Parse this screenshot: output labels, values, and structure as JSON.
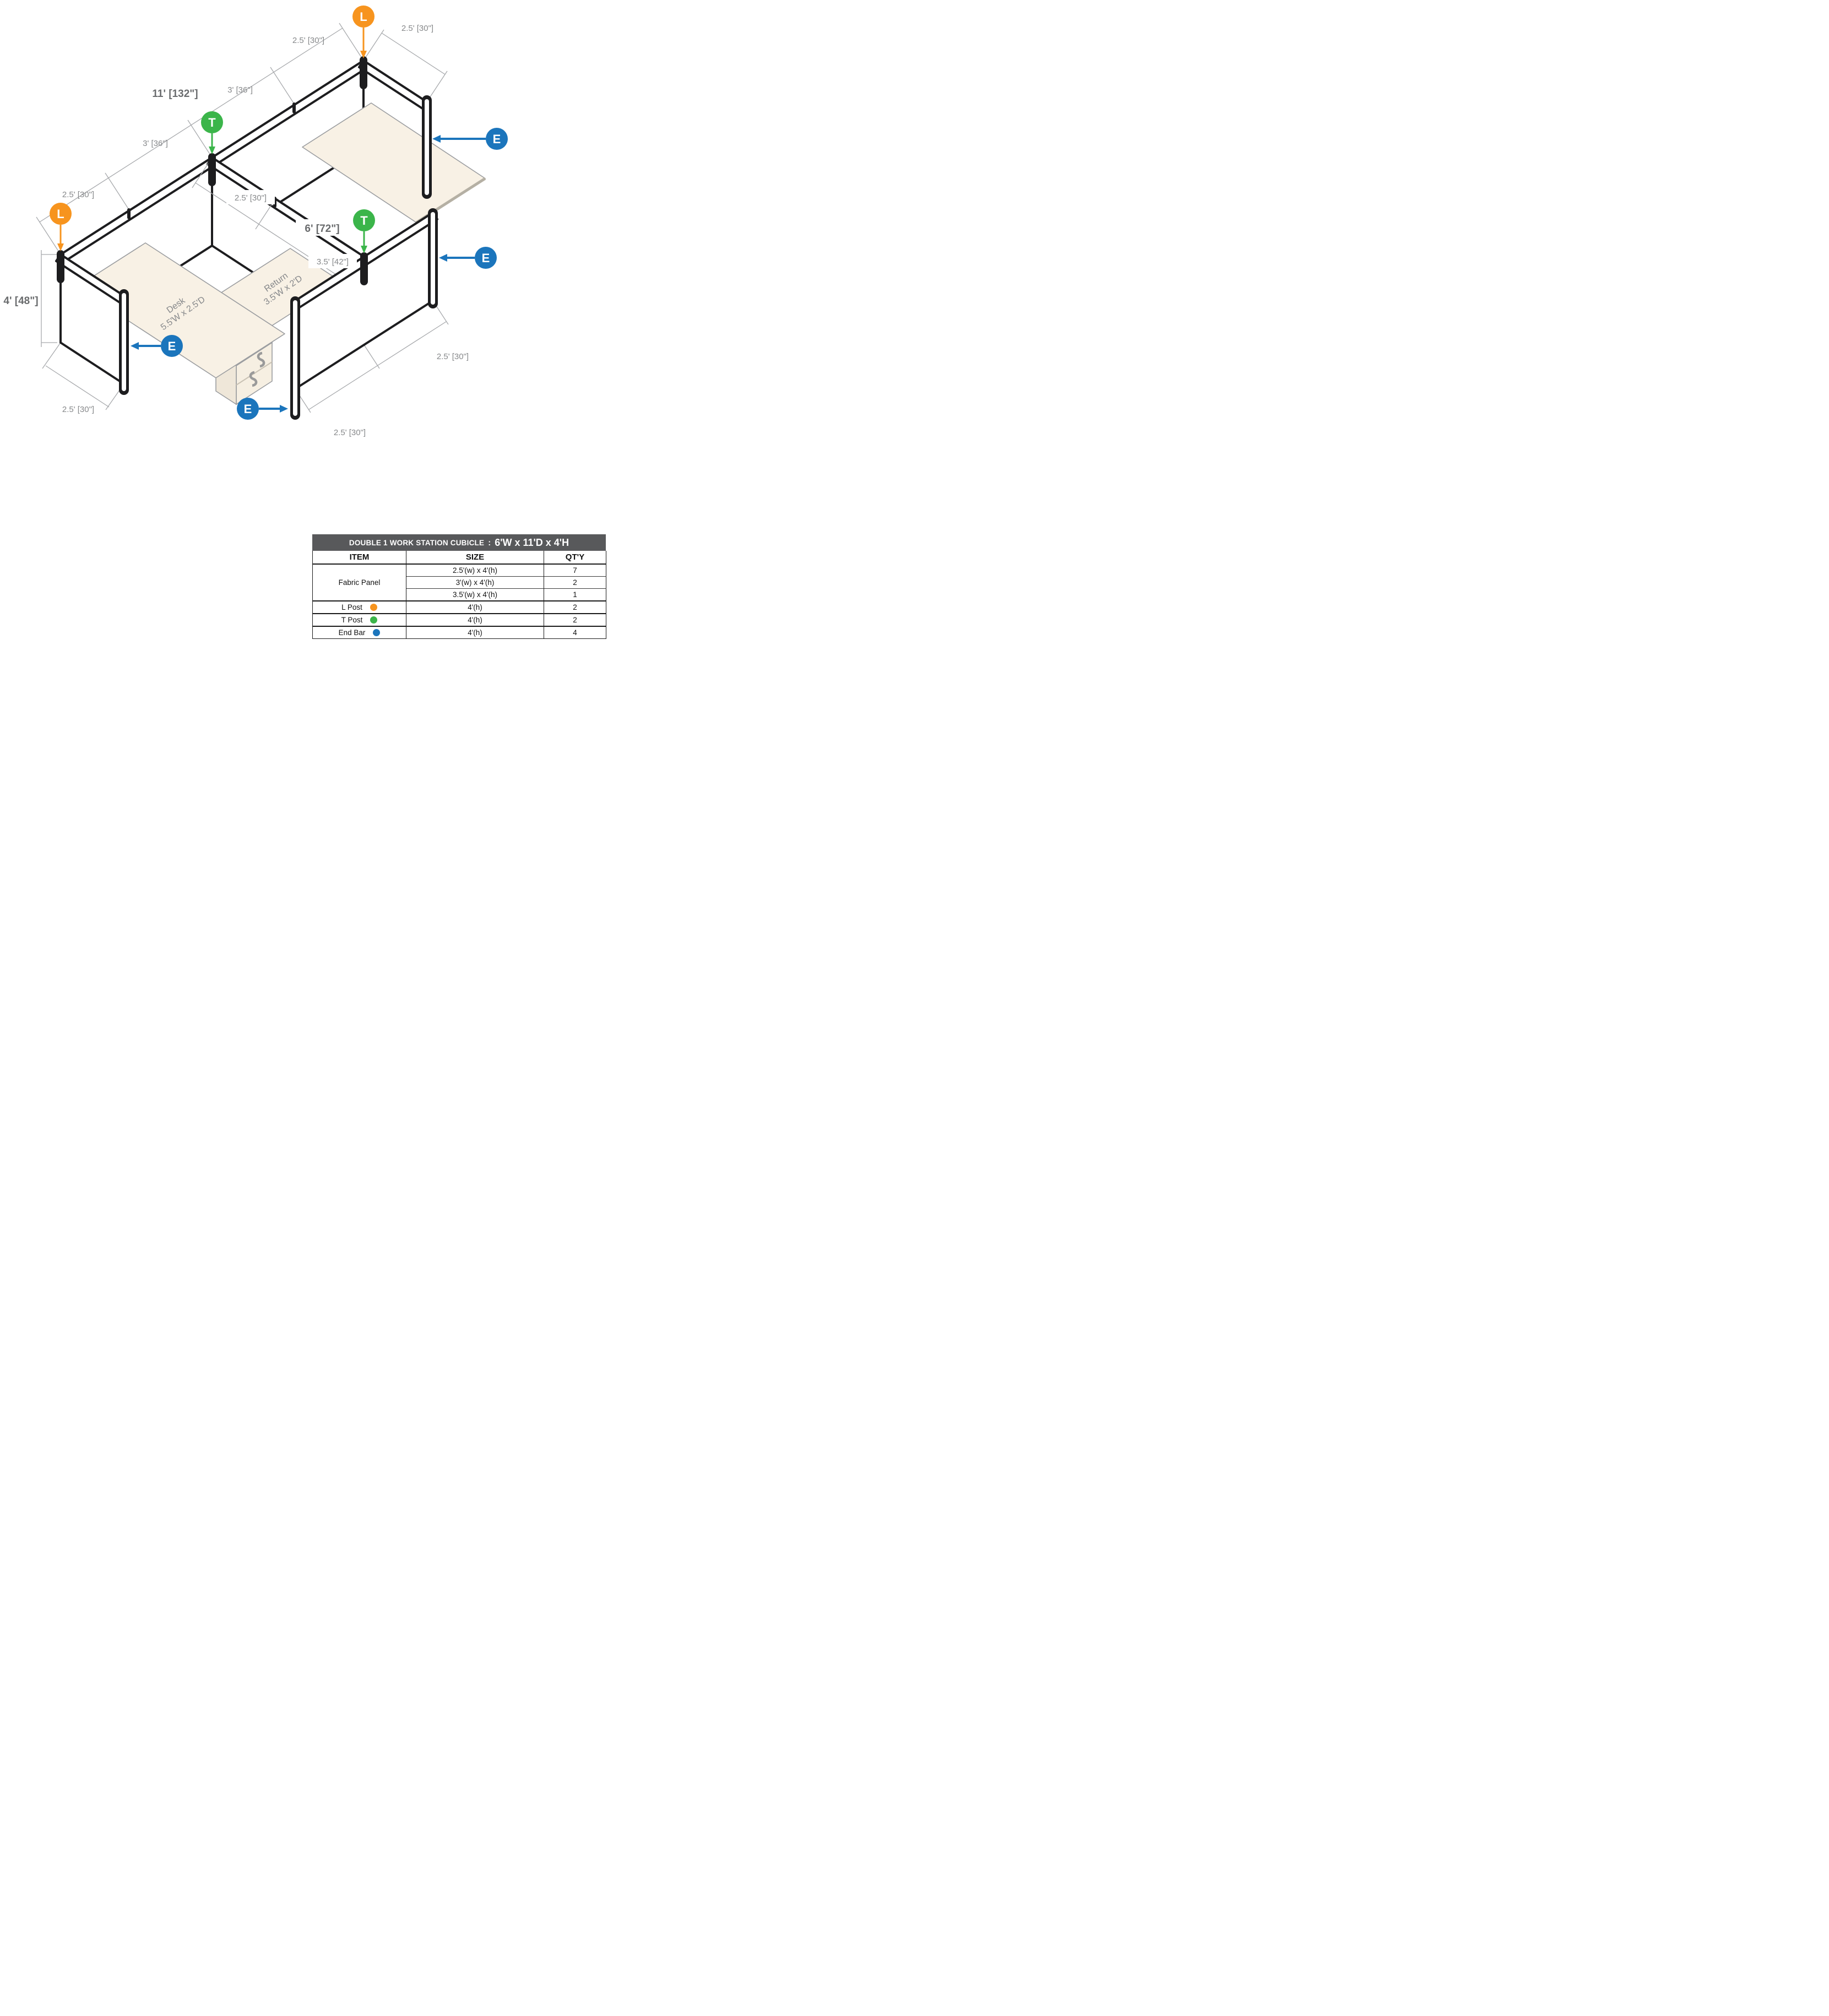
{
  "diagram": {
    "markers": {
      "l": "L",
      "t": "T",
      "e": "E",
      "l_color": "#F7941E",
      "t_color": "#3BB54A",
      "e_color": "#1B75BC"
    },
    "dims": {
      "wl_seg1": "2.5' [30\"]",
      "wtop": "2.5' [30\"]",
      "overall": "11' [132\"]",
      "wl_seg2": "3' [36\"]",
      "wl2_seg1": "3' [36\"]",
      "wl2_seg2": "2.5' [30\"]",
      "spine_seg1": "2.5' [30\"]",
      "spine_total": "6' [72\"]",
      "spine_seg2": "3.5' [42\"]",
      "height": "4' [48\"]",
      "wbot": "2.5' [30\"]",
      "rdn": "2.5' [30\"]",
      "rup": "2.5' [30\"]"
    },
    "surfaces": {
      "desk_title": "Desk",
      "desk_size": "5.5'W x 2.5'D",
      "return_title": "Return",
      "return_size": "3.5'W x 2'D"
    }
  },
  "table": {
    "title": "DOUBLE 1 WORK STATION CUBICLE",
    "sep": ":",
    "title_size": "6'W x 11'D x 4'H",
    "columns": [
      "ITEM",
      "SIZE",
      "QT'Y"
    ],
    "rows": {
      "fabric": {
        "item": "Fabric Panel",
        "sizes": [
          "2.5'(w) x 4'(h)",
          "3'(w) x 4'(h)",
          "3.5'(w) x 4'(h)"
        ],
        "qtys": [
          "7",
          "2",
          "1"
        ]
      },
      "l_post": {
        "item": "L Post",
        "size": "4'(h)",
        "qty": "2",
        "color": "#F7941E"
      },
      "t_post": {
        "item": "T Post",
        "size": "4'(h)",
        "qty": "2",
        "color": "#3BB54A"
      },
      "end_bar": {
        "item": "End Bar",
        "size": "4'(h)",
        "qty": "4",
        "color": "#1B75BC"
      }
    }
  }
}
